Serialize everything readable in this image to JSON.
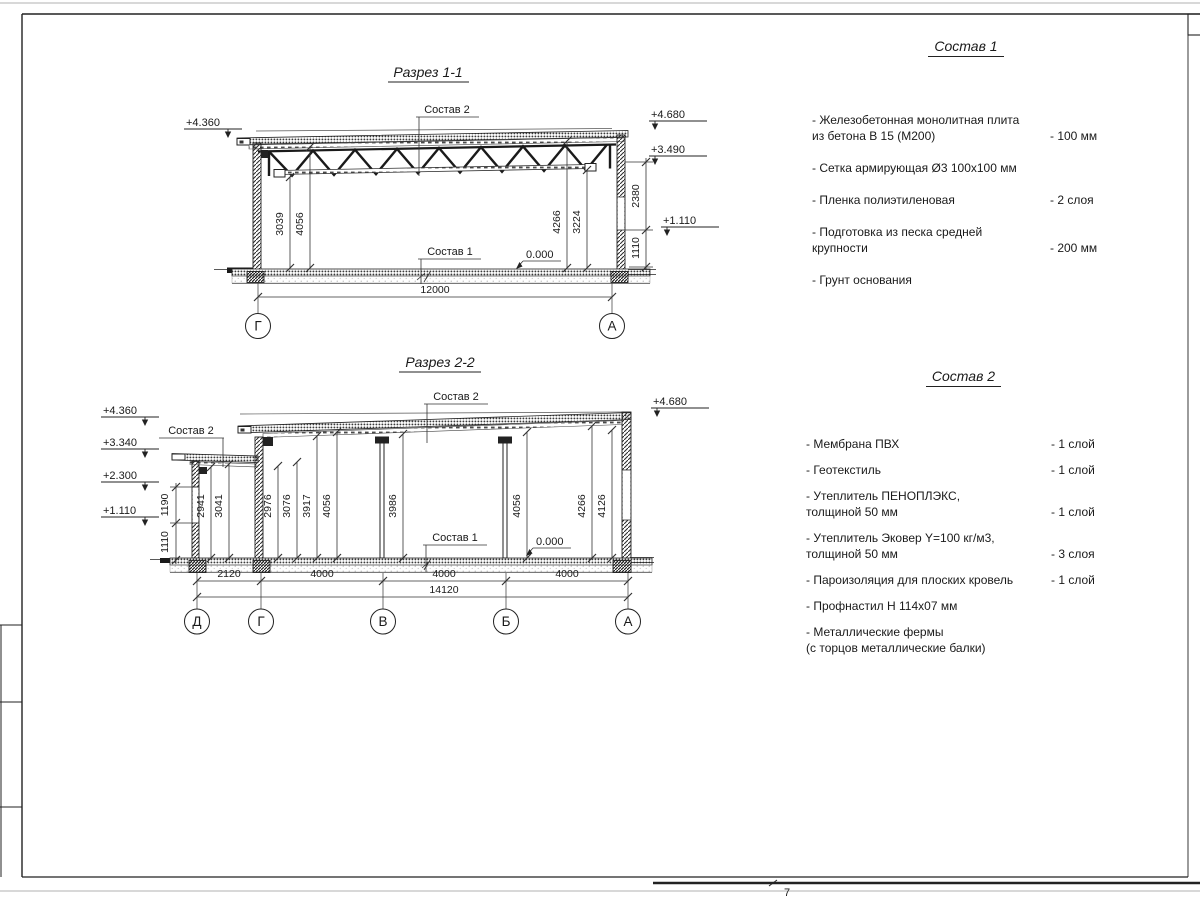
{
  "sheet": {
    "page_note": "7"
  },
  "s1": {
    "title": "Разрез 1-1",
    "labels": {
      "sostav2": "Состав 2",
      "sostav1": "Состав 1",
      "zero": "0.000"
    },
    "elev": {
      "left_top": "+4.360",
      "right_top": "+4.680",
      "right_mid": "+3.490",
      "right_low": "+1.110"
    },
    "dims_v": [
      "3039",
      "4056",
      "4266",
      "3224"
    ],
    "dims_right": [
      "2380",
      "1110"
    ],
    "span": "12000",
    "axes": [
      "Г",
      "А"
    ]
  },
  "s2": {
    "title": "Разрез 2-2",
    "labels": {
      "sostav2_left": "Состав 2",
      "sostav2_top": "Состав 2",
      "sostav1": "Состав 1",
      "zero": "0.000"
    },
    "elev": {
      "l1": "+4.360",
      "l2": "+3.340",
      "l3": "+2.300",
      "l4": "+1.110",
      "right": "+4.680"
    },
    "dims_left": [
      "1190",
      "1110"
    ],
    "dims_v": [
      "2941",
      "3041",
      "2976",
      "3076",
      "3917",
      "4056",
      "3986",
      "4056",
      "4266",
      "4126"
    ],
    "dims_bottom": [
      "2120",
      "4000",
      "4000",
      "4000"
    ],
    "total": "14120",
    "axes": [
      "Д",
      "Г",
      "В",
      "Б",
      "А"
    ]
  },
  "lists": {
    "sostav1": {
      "heading": "Состав 1",
      "items": [
        {
          "name": "- Железобетонная  монолитная плита",
          "name2": "из бетона В 15 (М200)",
          "value": "- 100 мм"
        },
        {
          "name": "- Сетка армирующая Ø3 100х100 мм",
          "name2": "",
          "value": ""
        },
        {
          "name": "- Пленка полиэтиленовая",
          "name2": "",
          "value": "-  2 слоя"
        },
        {
          "name": "- Подготовка из песка средней",
          "name2": "крупности",
          "value": "- 200 мм"
        },
        {
          "name": "- Грунт основания",
          "name2": "",
          "value": ""
        }
      ]
    },
    "sostav2": {
      "heading": "Состав 2",
      "items": [
        {
          "name": "- Мембрана ПВХ",
          "name2": "",
          "value": "- 1 слой"
        },
        {
          "name": "- Геотекстиль",
          "name2": "",
          "value": "- 1 слой"
        },
        {
          "name": "- Утеплитель ПЕНОПЛЭКС,",
          "name2": "толщиной 50 мм",
          "value": "- 1 слой"
        },
        {
          "name": "- Утеплитель Эковер Y=100 кг/м3,",
          "name2": "толщиной 50 мм",
          "value": "- 3 слоя"
        },
        {
          "name": "- Пароизоляция для плоских кровель",
          "name2": "",
          "value": "- 1 слой"
        },
        {
          "name": "- Профнастил Н 114х07 мм",
          "name2": "",
          "value": ""
        },
        {
          "name": "- Металлические фермы",
          "name2": "(с торцов металлические балки)",
          "value": ""
        }
      ]
    }
  }
}
